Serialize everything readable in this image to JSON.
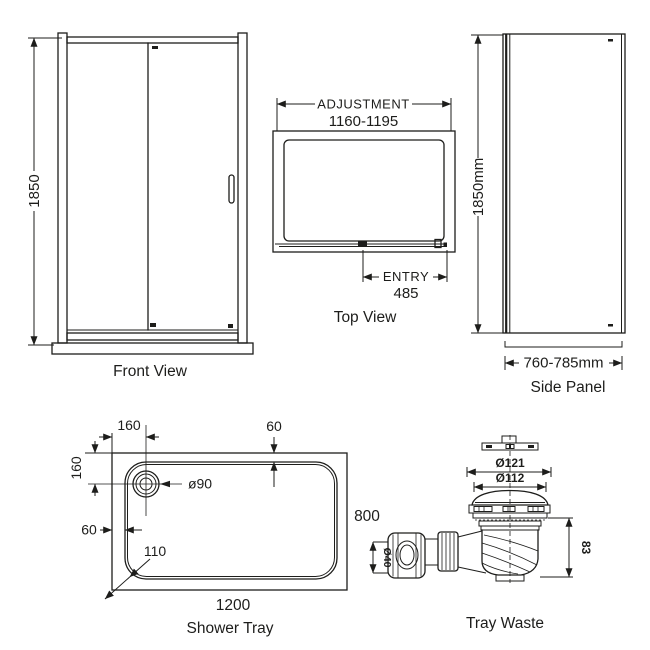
{
  "title": "Shower enclosure technical diagram",
  "colors": {
    "line": "#1d1d1b",
    "background": "#ffffff"
  },
  "front_view": {
    "label": "Front View",
    "height_dim": "1850"
  },
  "top_view": {
    "label": "Top View",
    "adjustment_label": "ADJUSTMENT",
    "adjustment_range": "1160-1195",
    "entry_label": "ENTRY",
    "entry_width": "485"
  },
  "side_panel": {
    "label": "Side Panel",
    "height_dim": "1850mm",
    "width_dim": "760-785mm"
  },
  "shower_tray": {
    "label": "Shower Tray",
    "drain_offset_x": "160",
    "drain_offset_y": "160",
    "rim_inset_top": "60",
    "rim_inset_left": "60",
    "corner_radius": "110",
    "width_dim": "1200",
    "depth_dim": "800",
    "drain_diameter": "ø90"
  },
  "tray_waste": {
    "label": "Tray Waste",
    "flange_diameter": "Ø121",
    "cap_diameter": "Ø112",
    "body_height": "83",
    "outlet_diameter": "Ø40"
  }
}
